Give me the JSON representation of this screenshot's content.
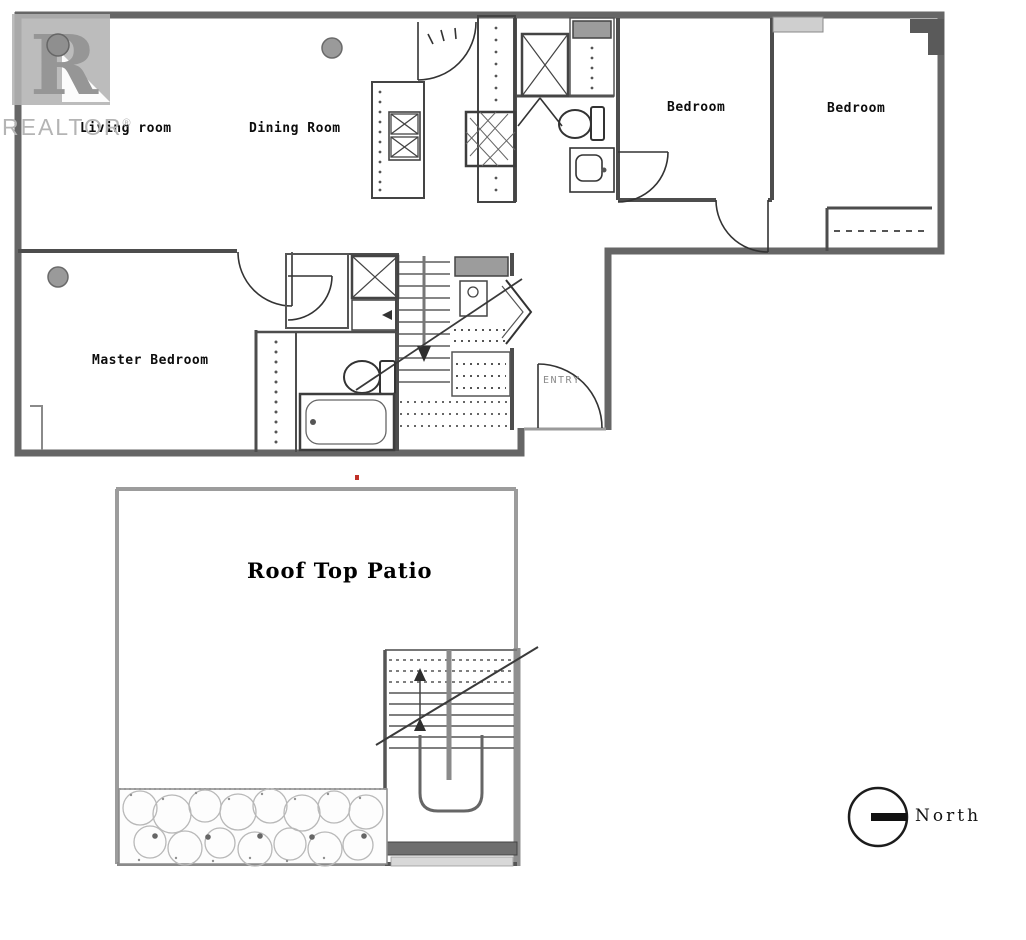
{
  "watermark": {
    "logo_letter": "R",
    "brand_text": "REALTOR",
    "registered_mark": "®"
  },
  "levels": {
    "main": {
      "rooms": {
        "living_room": "Living room",
        "dining_room": "Dining Room",
        "bedroom_1": "Bedroom",
        "bedroom_2": "Bedroom",
        "master_bedroom": "Master Bedroom",
        "entry": "ENTRY"
      }
    },
    "roof": {
      "rooms": {
        "roof_top_patio": "Roof Top Patio"
      }
    }
  },
  "compass": {
    "label": "North"
  },
  "fixtures": [
    "kitchen-island-icon",
    "stove-burners-icon",
    "kitchen-sink-icon",
    "shower-icon",
    "washer-dryer-closet-icon",
    "hall-toilet-icon",
    "hall-vanity-sink-icon",
    "master-toilet-icon",
    "bathtub-icon",
    "closet-rod-icon",
    "interior-stairs-icon",
    "roof-stairs-icon",
    "planter-garden-icon",
    "entry-door-icon",
    "ceiling-light-icon",
    "north-compass-icon"
  ],
  "colors": {
    "exterior_wall": "#666666",
    "interior_wall": "#4d4d4d",
    "light_wall": "#9c9c9c",
    "label_black": "#0d0d0d",
    "watermark_gray": "#b4b4b4",
    "artifact_red": "#c03028",
    "background": "#ffffff"
  }
}
